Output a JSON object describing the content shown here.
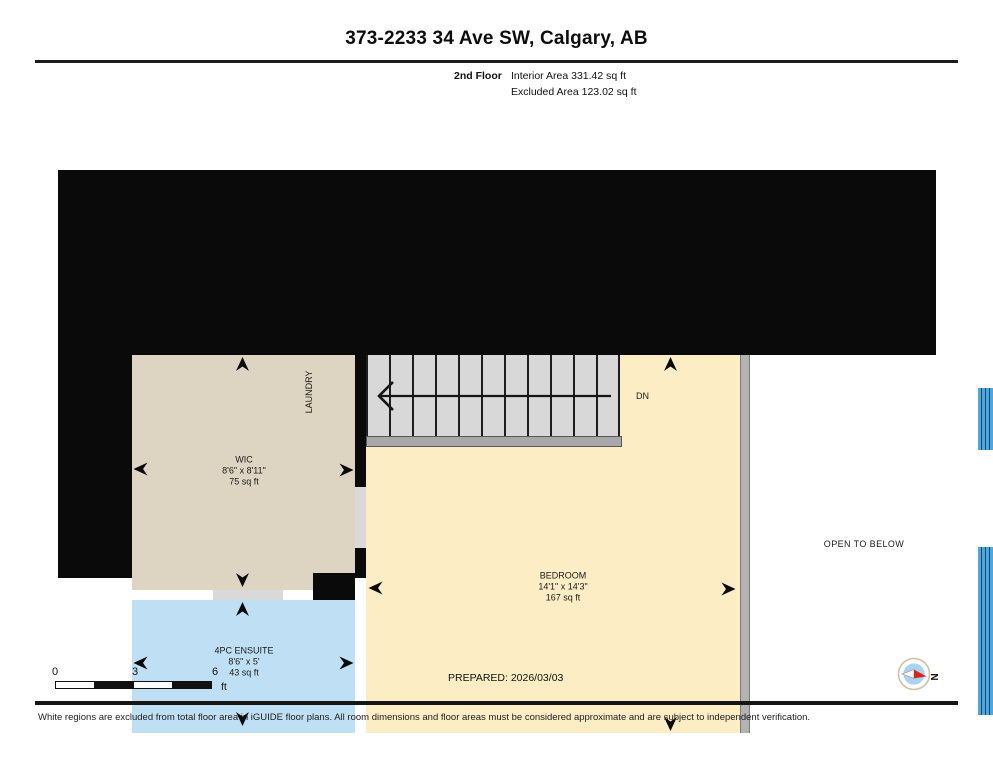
{
  "header": {
    "title": "373-2233 34 Ave SW, Calgary, AB",
    "floor_label": "2nd Floor",
    "interior_area": "Interior Area 331.42 sq ft",
    "excluded_area": "Excluded Area 123.02 sq ft"
  },
  "plan": {
    "rooms": [
      {
        "name": "WIC",
        "dims": "8'6\" x 8'11\"",
        "area": "75 sq ft"
      },
      {
        "name": "4PC ENSUITE",
        "dims": "8'6\" x 5'",
        "area": "43 sq ft"
      },
      {
        "name": "BEDROOM",
        "dims": "14'1\" x 14'3\"",
        "area": "167 sq ft"
      }
    ],
    "labels": {
      "laundry": "LAUNDRY",
      "open_to_below": "OPEN TO BELOW",
      "stair_direction": "DN"
    }
  },
  "footer": {
    "scale": {
      "ticks": [
        "0",
        "3",
        "6"
      ],
      "unit": "ft"
    },
    "prepared": "PREPARED: 2026/03/03",
    "compass": {
      "north_label": "N"
    },
    "disclaimer": "White regions are excluded from total floor area in iGUIDE floor plans. All room dimensions and floor areas must be considered approximate and are subject to independent verification."
  },
  "colors": {
    "wall": "#0a0a0a",
    "wic_fill": "#ded4c2",
    "ensuite_fill": "#bfe0f4",
    "bedroom_fill": "#fcedc4",
    "stairs_fill": "#d8d8d8",
    "railing": "#b3b3b3",
    "window_blue": "#4da7dc",
    "compass_red": "#d9251d"
  }
}
